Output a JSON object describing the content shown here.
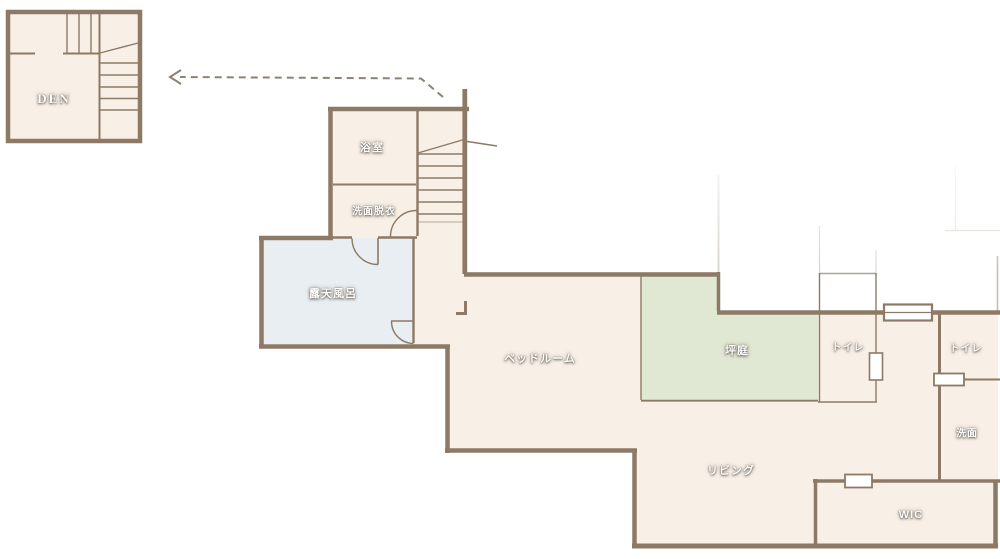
{
  "plan": {
    "title": "floor-plan",
    "labels": {
      "den": "DEN",
      "bath": "浴室",
      "dressing": "洗面脱衣",
      "open_air_bath": "露天風呂",
      "bedroom": "ベッドルーム",
      "courtyard": "坪庭",
      "toilet_a": "トイレ",
      "toilet_b": "トイレ",
      "washstand": "洗面",
      "living": "リビング",
      "wic": "WIC"
    },
    "colors": {
      "wall": "#8d7a66",
      "floor": "#f8f0e7",
      "courtyard_fill": "#e0e7d3",
      "bath_fill": "#e9eef2",
      "arrow": "#8c8372",
      "label_text": "#ffffff"
    }
  }
}
